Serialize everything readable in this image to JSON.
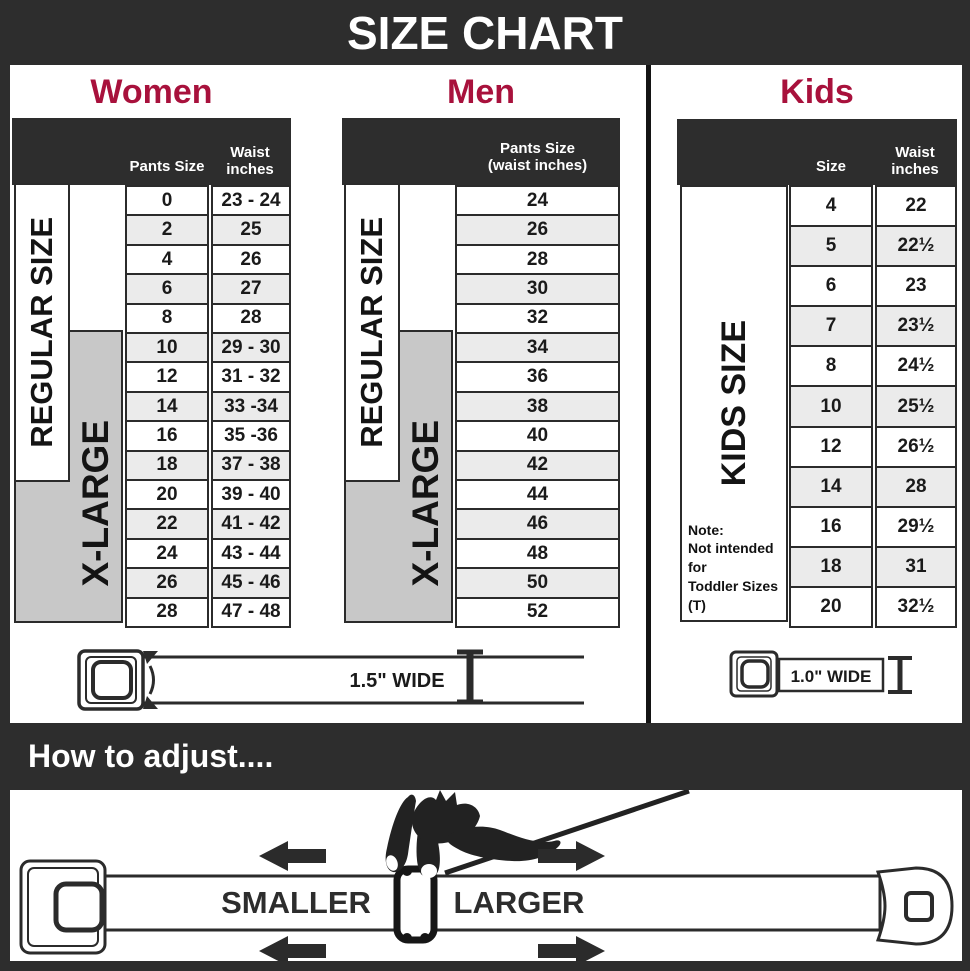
{
  "title": "SIZE CHART",
  "colors": {
    "frame": "#2d2d2d",
    "accent": "#a8113c",
    "label_gray": "#c8c8c8",
    "row_alt": "#ebebeb",
    "line": "#2b2b2b"
  },
  "women": {
    "heading": "Women",
    "col1_header": "Pants Size",
    "col2_header_line1": "Waist",
    "col2_header_line2": "inches",
    "regular_label": "REGULAR SIZE",
    "xlarge_label": "X-LARGE",
    "rows": [
      {
        "size": "0",
        "waist": "23 - 24"
      },
      {
        "size": "2",
        "waist": "25"
      },
      {
        "size": "4",
        "waist": "26"
      },
      {
        "size": "6",
        "waist": "27"
      },
      {
        "size": "8",
        "waist": "28"
      },
      {
        "size": "10",
        "waist": "29 - 30"
      },
      {
        "size": "12",
        "waist": "31 - 32"
      },
      {
        "size": "14",
        "waist": "33 -34"
      },
      {
        "size": "16",
        "waist": "35 -36"
      },
      {
        "size": "18",
        "waist": "37 - 38"
      },
      {
        "size": "20",
        "waist": "39 - 40"
      },
      {
        "size": "22",
        "waist": "41 - 42"
      },
      {
        "size": "24",
        "waist": "43 - 44"
      },
      {
        "size": "26",
        "waist": "45 - 46"
      },
      {
        "size": "28",
        "waist": "47 - 48"
      }
    ]
  },
  "men": {
    "heading": "Men",
    "col_header_line1": "Pants Size",
    "col_header_line2": "(waist inches)",
    "regular_label": "REGULAR SIZE",
    "xlarge_label": "X-LARGE",
    "rows": [
      "24",
      "26",
      "28",
      "30",
      "32",
      "34",
      "36",
      "38",
      "40",
      "42",
      "44",
      "46",
      "48",
      "50",
      "52"
    ]
  },
  "kids": {
    "heading": "Kids",
    "col1_header": "Size",
    "col2_header_line1": "Waist",
    "col2_header_line2": "inches",
    "label": "KIDS SIZE",
    "note": [
      "Note:",
      "Not intended for",
      "Toddler Sizes (T)"
    ],
    "rows": [
      {
        "size": "4",
        "waist": "22"
      },
      {
        "size": "5",
        "waist": "22½"
      },
      {
        "size": "6",
        "waist": "23"
      },
      {
        "size": "7",
        "waist": "23½"
      },
      {
        "size": "8",
        "waist": "24½"
      },
      {
        "size": "10",
        "waist": "25½"
      },
      {
        "size": "12",
        "waist": "26½"
      },
      {
        "size": "14",
        "waist": "28"
      },
      {
        "size": "16",
        "waist": "29½"
      },
      {
        "size": "18",
        "waist": "31"
      },
      {
        "size": "20",
        "waist": "32½"
      }
    ]
  },
  "women_men_belt": {
    "width_label": "1.5\" WIDE"
  },
  "kids_belt": {
    "width_label": "1.0\" WIDE"
  },
  "adjust": {
    "heading": "How to adjust....",
    "smaller_label": "SMALLER",
    "larger_label": "LARGER"
  }
}
